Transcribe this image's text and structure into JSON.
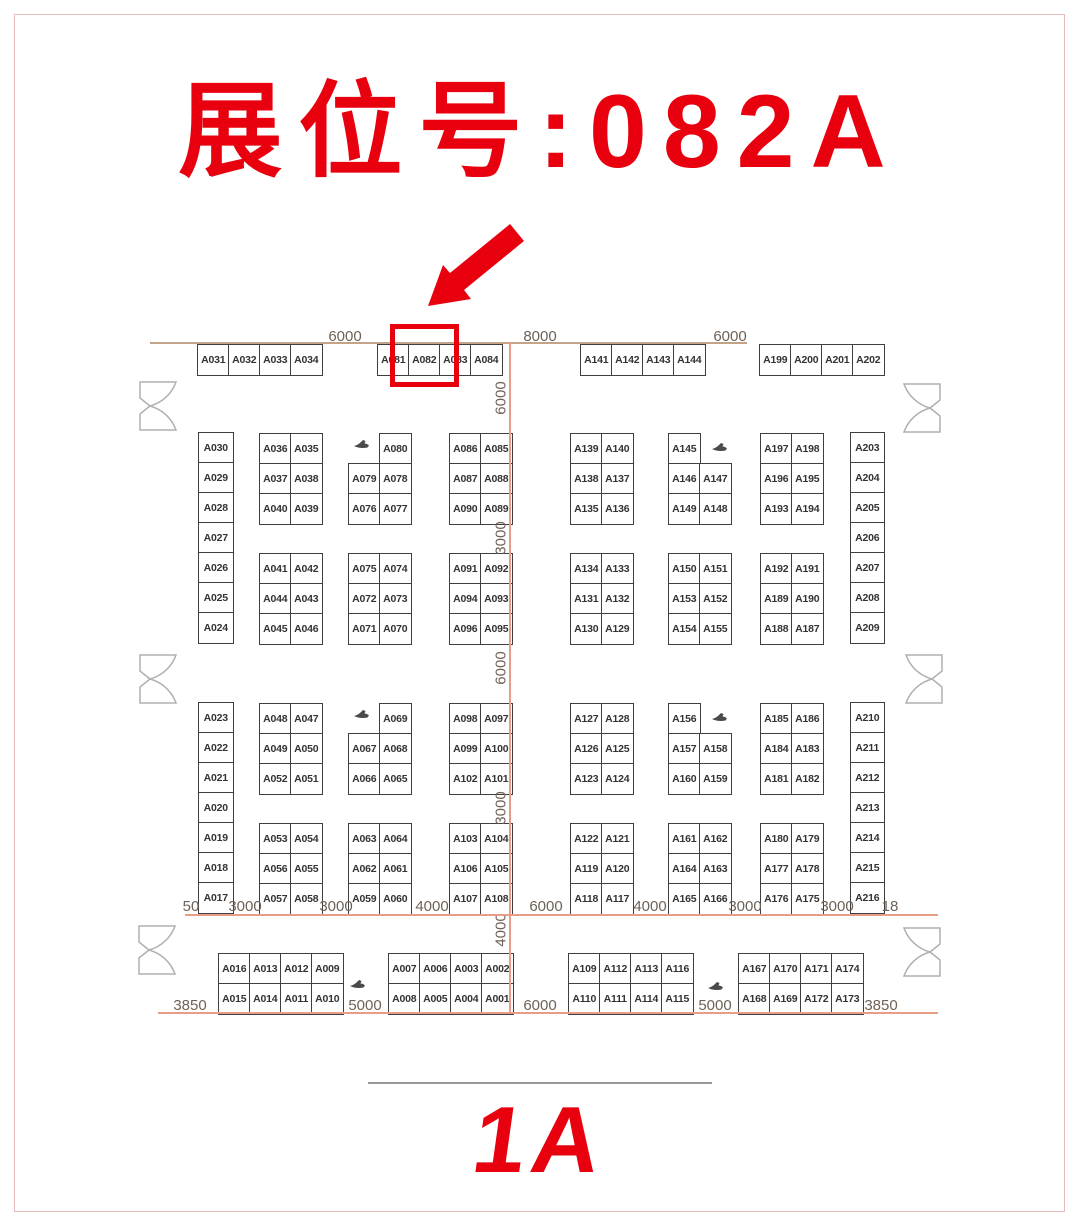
{
  "page": {
    "title": "展位号:082A",
    "hall_label": "1A"
  },
  "colors": {
    "accent_red": "#e8000f",
    "booth_line": "#3f3f3f",
    "booth_text": "#333333",
    "dim_text": "#6e6257",
    "wall_line": "#c4a488",
    "dim_line": "#e79d88",
    "door_line": "#b0b0b0",
    "car": "#4a4a4a",
    "page_border": "#e7bcbc",
    "separator": "#999999"
  },
  "annotation": {
    "highlighted_booth": "A082"
  },
  "plan": {
    "booth_grids": [
      {
        "x": 197,
        "y": 344,
        "rows": [
          [
            "A031",
            "A032",
            "A033",
            "A034"
          ]
        ]
      },
      {
        "x": 377,
        "y": 344,
        "rows": [
          [
            "A081",
            "A082",
            "A083",
            "A084"
          ]
        ]
      },
      {
        "x": 580,
        "y": 344,
        "rows": [
          [
            "A141",
            "A142",
            "A143",
            "A144"
          ]
        ]
      },
      {
        "x": 759,
        "y": 344,
        "rows": [
          [
            "A199",
            "A200",
            "A201",
            "A202"
          ]
        ]
      },
      {
        "x": 198,
        "y": 432,
        "cell_w": 34,
        "rows": [
          [
            "A030"
          ],
          [
            "A029"
          ],
          [
            "A028"
          ],
          [
            "A027"
          ],
          [
            "A026"
          ],
          [
            "A025"
          ],
          [
            "A024"
          ]
        ]
      },
      {
        "x": 198,
        "y": 702,
        "cell_w": 34,
        "rows": [
          [
            "A023"
          ],
          [
            "A022"
          ],
          [
            "A021"
          ],
          [
            "A020"
          ],
          [
            "A019"
          ],
          [
            "A018"
          ],
          [
            "A017"
          ]
        ]
      },
      {
        "x": 850,
        "y": 432,
        "cell_w": 33,
        "rows": [
          [
            "A203"
          ],
          [
            "A204"
          ],
          [
            "A205"
          ],
          [
            "A206"
          ],
          [
            "A207"
          ],
          [
            "A208"
          ],
          [
            "A209"
          ]
        ]
      },
      {
        "x": 850,
        "y": 702,
        "cell_w": 33,
        "rows": [
          [
            "A210"
          ],
          [
            "A211"
          ],
          [
            "A212"
          ],
          [
            "A213"
          ],
          [
            "A214"
          ],
          [
            "A215"
          ],
          [
            "A216"
          ]
        ]
      },
      {
        "x": 259,
        "y": 433,
        "rows": [
          [
            "A036",
            "A035"
          ],
          [
            "A037",
            "A038"
          ],
          [
            "A040",
            "A039"
          ]
        ]
      },
      {
        "x": 379,
        "y": 433,
        "rows": [
          [
            "A080"
          ]
        ]
      },
      {
        "x": 348,
        "y": 463,
        "rows": [
          [
            "A079",
            "A078"
          ],
          [
            "A076",
            "A077"
          ]
        ]
      },
      {
        "x": 449,
        "y": 433,
        "rows": [
          [
            "A086",
            "A085"
          ],
          [
            "A087",
            "A088"
          ],
          [
            "A090",
            "A089"
          ]
        ]
      },
      {
        "x": 570,
        "y": 433,
        "rows": [
          [
            "A139",
            "A140"
          ],
          [
            "A138",
            "A137"
          ],
          [
            "A135",
            "A136"
          ]
        ]
      },
      {
        "x": 668,
        "y": 433,
        "rows": [
          [
            "A145"
          ]
        ]
      },
      {
        "x": 668,
        "y": 463,
        "rows": [
          [
            "A146",
            "A147"
          ],
          [
            "A149",
            "A148"
          ]
        ]
      },
      {
        "x": 760,
        "y": 433,
        "rows": [
          [
            "A197",
            "A198"
          ],
          [
            "A196",
            "A195"
          ],
          [
            "A193",
            "A194"
          ]
        ]
      },
      {
        "x": 259,
        "y": 553,
        "rows": [
          [
            "A041",
            "A042"
          ],
          [
            "A044",
            "A043"
          ],
          [
            "A045",
            "A046"
          ]
        ]
      },
      {
        "x": 348,
        "y": 553,
        "rows": [
          [
            "A075",
            "A074"
          ],
          [
            "A072",
            "A073"
          ],
          [
            "A071",
            "A070"
          ]
        ]
      },
      {
        "x": 449,
        "y": 553,
        "rows": [
          [
            "A091",
            "A092"
          ],
          [
            "A094",
            "A093"
          ],
          [
            "A096",
            "A095"
          ]
        ]
      },
      {
        "x": 570,
        "y": 553,
        "rows": [
          [
            "A134",
            "A133"
          ],
          [
            "A131",
            "A132"
          ],
          [
            "A130",
            "A129"
          ]
        ]
      },
      {
        "x": 668,
        "y": 553,
        "rows": [
          [
            "A150",
            "A151"
          ],
          [
            "A153",
            "A152"
          ],
          [
            "A154",
            "A155"
          ]
        ]
      },
      {
        "x": 760,
        "y": 553,
        "rows": [
          [
            "A192",
            "A191"
          ],
          [
            "A189",
            "A190"
          ],
          [
            "A188",
            "A187"
          ]
        ]
      },
      {
        "x": 259,
        "y": 703,
        "rows": [
          [
            "A048",
            "A047"
          ],
          [
            "A049",
            "A050"
          ],
          [
            "A052",
            "A051"
          ]
        ]
      },
      {
        "x": 379,
        "y": 703,
        "rows": [
          [
            "A069"
          ]
        ]
      },
      {
        "x": 348,
        "y": 733,
        "rows": [
          [
            "A067",
            "A068"
          ],
          [
            "A066",
            "A065"
          ]
        ]
      },
      {
        "x": 449,
        "y": 703,
        "rows": [
          [
            "A098",
            "A097"
          ],
          [
            "A099",
            "A100"
          ],
          [
            "A102",
            "A101"
          ]
        ]
      },
      {
        "x": 570,
        "y": 703,
        "rows": [
          [
            "A127",
            "A128"
          ],
          [
            "A126",
            "A125"
          ],
          [
            "A123",
            "A124"
          ]
        ]
      },
      {
        "x": 668,
        "y": 703,
        "rows": [
          [
            "A156"
          ]
        ]
      },
      {
        "x": 668,
        "y": 733,
        "rows": [
          [
            "A157",
            "A158"
          ],
          [
            "A160",
            "A159"
          ]
        ]
      },
      {
        "x": 760,
        "y": 703,
        "rows": [
          [
            "A185",
            "A186"
          ],
          [
            "A184",
            "A183"
          ],
          [
            "A181",
            "A182"
          ]
        ]
      },
      {
        "x": 259,
        "y": 823,
        "rows": [
          [
            "A053",
            "A054"
          ],
          [
            "A056",
            "A055"
          ],
          [
            "A057",
            "A058"
          ]
        ]
      },
      {
        "x": 348,
        "y": 823,
        "rows": [
          [
            "A063",
            "A064"
          ],
          [
            "A062",
            "A061"
          ],
          [
            "A059",
            "A060"
          ]
        ]
      },
      {
        "x": 449,
        "y": 823,
        "rows": [
          [
            "A103",
            "A104"
          ],
          [
            "A106",
            "A105"
          ],
          [
            "A107",
            "A108"
          ]
        ]
      },
      {
        "x": 570,
        "y": 823,
        "rows": [
          [
            "A122",
            "A121"
          ],
          [
            "A119",
            "A120"
          ],
          [
            "A118",
            "A117"
          ]
        ]
      },
      {
        "x": 668,
        "y": 823,
        "rows": [
          [
            "A161",
            "A162"
          ],
          [
            "A164",
            "A163"
          ],
          [
            "A165",
            "A166"
          ]
        ]
      },
      {
        "x": 760,
        "y": 823,
        "rows": [
          [
            "A180",
            "A179"
          ],
          [
            "A177",
            "A178"
          ],
          [
            "A176",
            "A175"
          ]
        ]
      },
      {
        "x": 218,
        "y": 953,
        "rows": [
          [
            "A016",
            "A013",
            "A012",
            "A009"
          ],
          [
            "A015",
            "A014",
            "A011",
            "A010"
          ]
        ]
      },
      {
        "x": 388,
        "y": 953,
        "rows": [
          [
            "A007",
            "A006",
            "A003",
            "A002"
          ],
          [
            "A008",
            "A005",
            "A004",
            "A001"
          ]
        ]
      },
      {
        "x": 568,
        "y": 953,
        "rows": [
          [
            "A109",
            "A112",
            "A113",
            "A116"
          ],
          [
            "A110",
            "A111",
            "A114",
            "A115"
          ]
        ]
      },
      {
        "x": 738,
        "y": 953,
        "rows": [
          [
            "A167",
            "A170",
            "A171",
            "A174"
          ],
          [
            "A168",
            "A169",
            "A172",
            "A173"
          ]
        ]
      }
    ],
    "dimension_labels": {
      "top": [
        {
          "text": "6000",
          "x": 345,
          "y": 328
        },
        {
          "text": "8000",
          "x": 540,
          "y": 328
        },
        {
          "text": "6000",
          "x": 730,
          "y": 328
        }
      ],
      "middle": [
        {
          "text": "50",
          "x": 191,
          "y": 898
        },
        {
          "text": "3000",
          "x": 245,
          "y": 898
        },
        {
          "text": "3000",
          "x": 336,
          "y": 898
        },
        {
          "text": "4000",
          "x": 432,
          "y": 898
        },
        {
          "text": "6000",
          "x": 546,
          "y": 898
        },
        {
          "text": "4000",
          "x": 650,
          "y": 898
        },
        {
          "text": "3000",
          "x": 745,
          "y": 898
        },
        {
          "text": "3000",
          "x": 837,
          "y": 898
        },
        {
          "text": "18",
          "x": 890,
          "y": 898
        }
      ],
      "bottom": [
        {
          "text": "3850",
          "x": 190,
          "y": 997
        },
        {
          "text": "5000",
          "x": 365,
          "y": 997
        },
        {
          "text": "6000",
          "x": 540,
          "y": 997
        },
        {
          "text": "5000",
          "x": 715,
          "y": 997
        },
        {
          "text": "3850",
          "x": 881,
          "y": 997
        }
      ],
      "center_vertical": [
        {
          "text": "6000",
          "y": 398
        },
        {
          "text": "3000",
          "y": 538
        },
        {
          "text": "6000",
          "y": 668
        },
        {
          "text": "3000",
          "y": 808
        },
        {
          "text": "4000",
          "y": 930
        }
      ]
    },
    "lines": [
      {
        "name": "top-wall-line",
        "x": 150,
        "y": 342,
        "w": 597,
        "h": 0,
        "color_key": "wall_line"
      },
      {
        "name": "center-axis-line",
        "x": 509,
        "y": 342,
        "w": 0,
        "h": 671,
        "color_key": "dim_line"
      },
      {
        "name": "mid-dimension-line",
        "x": 185,
        "y": 914,
        "w": 753,
        "h": 0,
        "color_key": "dim_line"
      },
      {
        "name": "bottom-dimension-line",
        "x": 158,
        "y": 1012,
        "w": 780,
        "h": 0,
        "color_key": "dim_line"
      }
    ],
    "doors": [
      {
        "x": 136,
        "y": 381,
        "flip": false
      },
      {
        "x": 136,
        "y": 654,
        "flip": false
      },
      {
        "x": 135,
        "y": 925,
        "flip": false
      },
      {
        "x": 902,
        "y": 383,
        "flip": true
      },
      {
        "x": 904,
        "y": 654,
        "flip": true
      },
      {
        "x": 902,
        "y": 927,
        "flip": true
      }
    ],
    "car_icons": [
      {
        "x": 353,
        "y": 439
      },
      {
        "x": 711,
        "y": 442
      },
      {
        "x": 353,
        "y": 709
      },
      {
        "x": 711,
        "y": 712
      },
      {
        "x": 349,
        "y": 979
      },
      {
        "x": 707,
        "y": 981
      }
    ]
  }
}
